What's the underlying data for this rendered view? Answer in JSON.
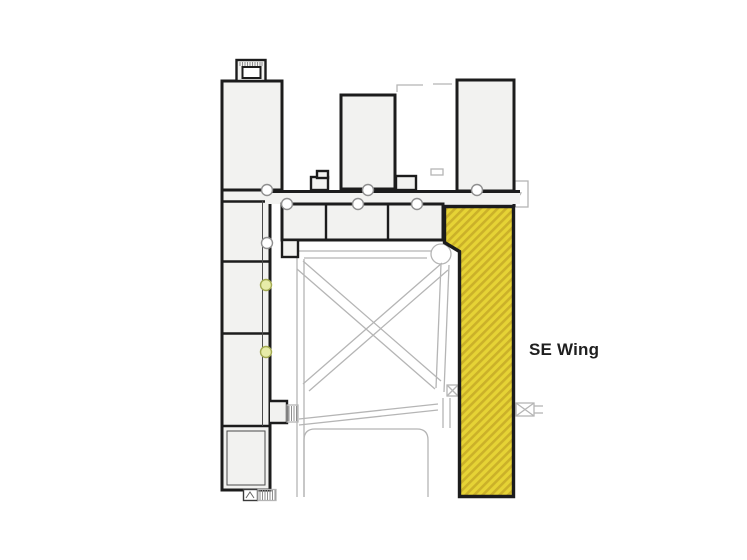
{
  "page": {
    "background": "#ffffff"
  },
  "plan": {
    "label": "SE Wing",
    "colors": {
      "wall": "#1c1c1c",
      "building_fill": "#f2f2f0",
      "path_gray": "#b5b5b5",
      "detail_gray": "#8f8f8f",
      "highlight_base": "#e6d335",
      "highlight_stripe": "#cbb129",
      "marker_fill": "#ffffff",
      "marker_stroke": "#8f8f8f",
      "marker_accent_fill": "#e7eca8",
      "marker_accent_stroke": "#a3aa52",
      "label_color": "#1f1f1f"
    }
  }
}
